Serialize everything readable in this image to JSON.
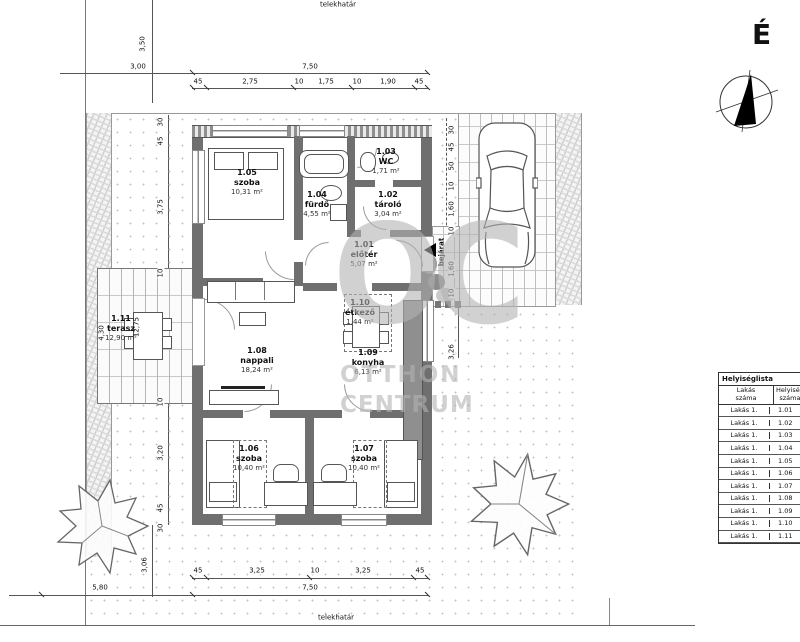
{
  "site": {
    "boundary_label_top": "telekhatár",
    "boundary_label_bottom": "telekhatár",
    "north_label": "É",
    "entrance_label": "bejárat"
  },
  "watermark": {
    "logo": "OC",
    "line1": "OTTHON",
    "line2": "CENTRUM"
  },
  "colors": {
    "wall": "#6f6f6f",
    "text": "#111111",
    "watermark": "#b2b2b2"
  },
  "rooms": [
    {
      "id": "1.05",
      "name": "szoba",
      "area": "10,31 m²"
    },
    {
      "id": "1.04",
      "name": "fürdő",
      "area": "4,55 m²"
    },
    {
      "id": "1.03",
      "name": "WC",
      "area": "1,71 m²"
    },
    {
      "id": "1.02",
      "name": "tároló",
      "area": "3,04 m²"
    },
    {
      "id": "1.01",
      "name": "előtér",
      "area": "5,07 m²"
    },
    {
      "id": "1.10",
      "name": "étkező",
      "area": "1,44 m²"
    },
    {
      "id": "1.08",
      "name": "nappali",
      "area": "18,24 m²"
    },
    {
      "id": "1.09",
      "name": "konyha",
      "area": "6,13 m²"
    },
    {
      "id": "1.06",
      "name": "szoba",
      "area": "10,40 m²"
    },
    {
      "id": "1.07",
      "name": "szoba",
      "area": "10,40 m²"
    },
    {
      "id": "1.11",
      "name": "terasz",
      "area": "12,90 m²"
    }
  ],
  "dims": {
    "t350": "3,50",
    "t300": "3,00",
    "t750": "7,50",
    "ts1": "45",
    "ts2": "2,75",
    "ts3": "10",
    "ts4": "1,75",
    "ts5": "10",
    "ts6": "1,90",
    "ts7": "45",
    "b580": "5,80",
    "b306": "3,06",
    "b750": "7,50",
    "bs1": "45",
    "bs2": "3,25",
    "bs3": "10",
    "bs4": "3,25",
    "bs5": "45",
    "l1": "30",
    "l2": "45",
    "l3": "3,75",
    "l4": "10",
    "l5": "4,30",
    "l6": "12,75",
    "l7": "10",
    "l8": "3,20",
    "l9": "45",
    "l10": "30",
    "r1": "30",
    "r2": "45",
    "r3": "50",
    "r4": "10",
    "r5": "1,60",
    "r6": "10",
    "r7": "1,60",
    "r8": "10",
    "r9": "3,26"
  },
  "table": {
    "title": "Helyiséglista",
    "col1_line1": "Lakás",
    "col1_line2": "száma",
    "col2_line1": "Helyiség",
    "col2_line2": "száma",
    "rows": [
      {
        "apt": "Lakás 1.",
        "num": "1.01"
      },
      {
        "apt": "Lakás 1.",
        "num": "1.02"
      },
      {
        "apt": "Lakás 1.",
        "num": "1.03"
      },
      {
        "apt": "Lakás 1.",
        "num": "1.04"
      },
      {
        "apt": "Lakás 1.",
        "num": "1.05"
      },
      {
        "apt": "Lakás 1.",
        "num": "1.06"
      },
      {
        "apt": "Lakás 1.",
        "num": "1.07"
      },
      {
        "apt": "Lakás 1.",
        "num": "1.08"
      },
      {
        "apt": "Lakás 1.",
        "num": "1.09"
      },
      {
        "apt": "Lakás 1.",
        "num": "1.10"
      },
      {
        "apt": "Lakás 1.",
        "num": "1.11"
      }
    ]
  }
}
